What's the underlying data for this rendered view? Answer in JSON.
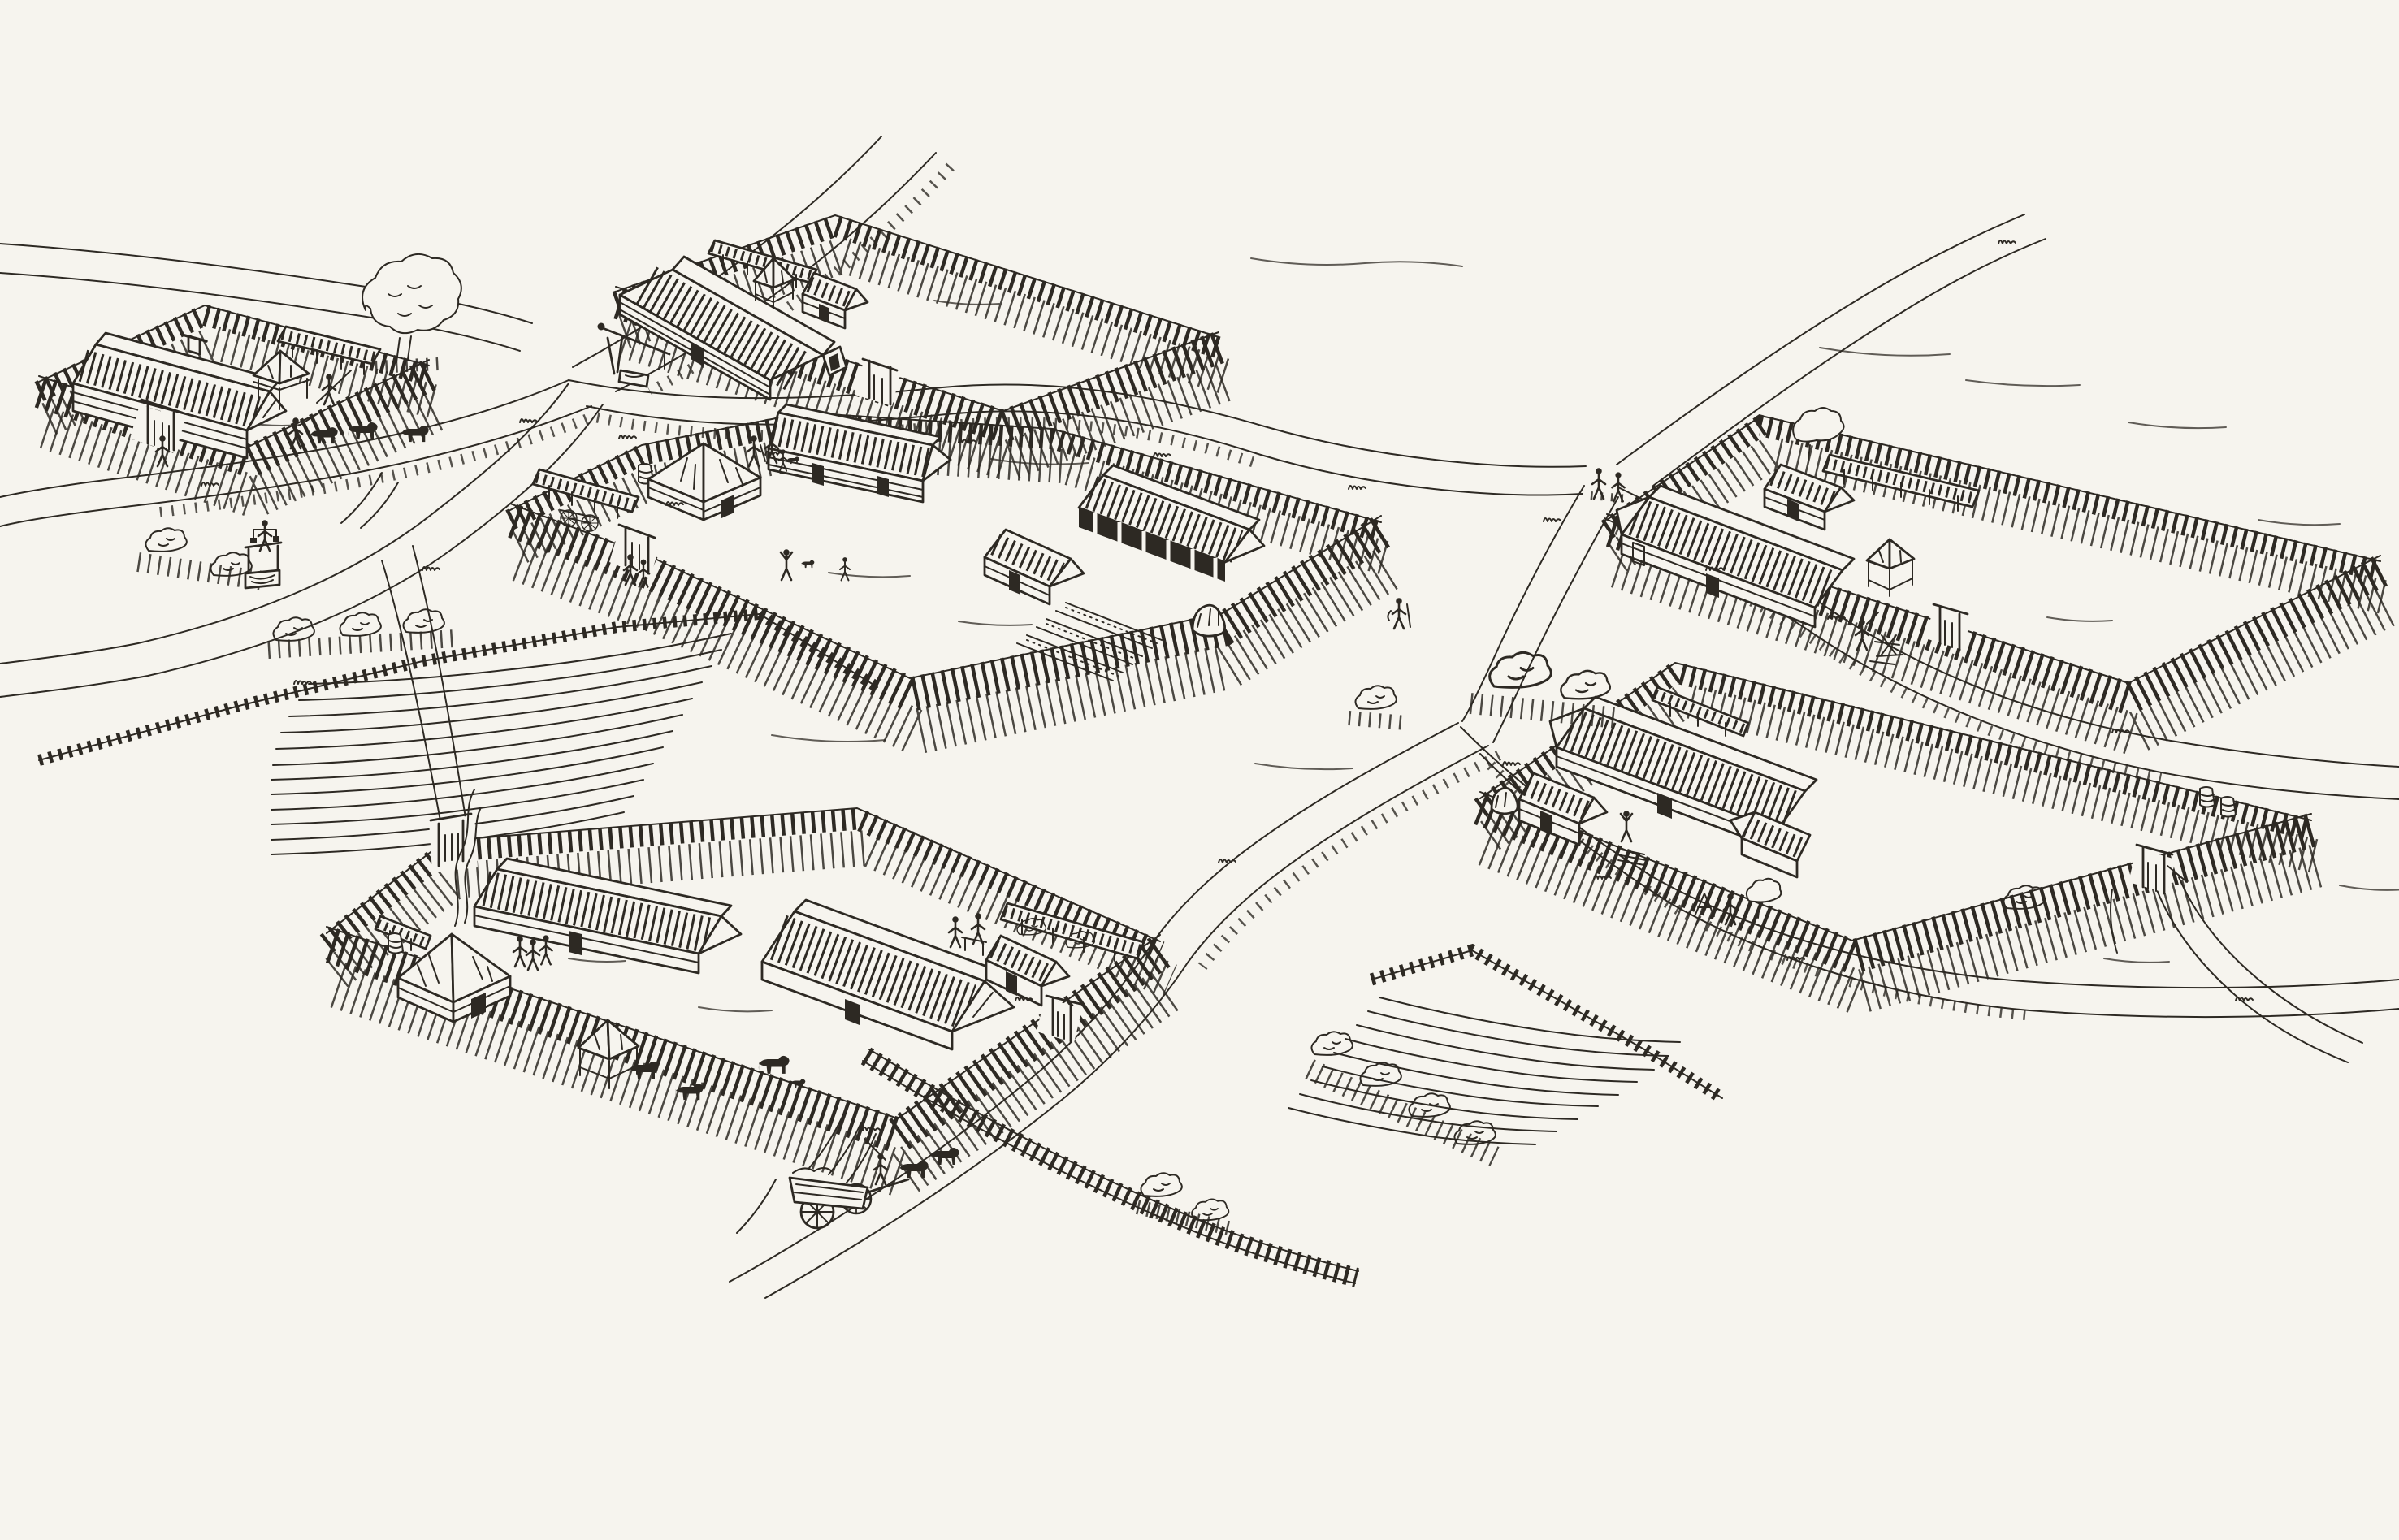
{
  "scene": {
    "title": "Aerial pen-and-ink reconstruction drawing of an early medieval village: six palisaded farmsteads with thatched log buildings along winding rural roads, ploughed strip fields, wells, villagers and livestock",
    "medium": "black ink line illustration on cream paper, high oblique bird's-eye view",
    "colors": {
      "paper": "#f6f4ee",
      "ink": "#2d2923"
    },
    "farmsteads": [
      {
        "id": "north-west-farmstead",
        "features": [
          "oval palisade fence",
          "thatched log longhouse with roof stack",
          "raised granary with pyramidal thatched roof",
          "open lean-to shelter along the fence",
          "large tree at the fence corner",
          "gate with lintel",
          "villager carrying a pole",
          "herdsman driving cattle on the road outside"
        ]
      },
      {
        "id": "north-central-farmstead",
        "features": [
          "large palisade enclosure with empty forecourt",
          "long thatched dwelling house with dark doorway",
          "small thatched outbuilding",
          "raised granary on posts",
          "open shelter along the rear fence",
          "gate",
          "timber well with posts and bucket outside the fence"
        ]
      },
      {
        "id": "central-farmstead",
        "features": [
          "large rounded palisade enclosure",
          "square house with pyramidal thatched roof",
          "long thatched house with two doors",
          "open-fronted thatched byre",
          "small thatched outbuilding",
          "lean-to shed sheltering a two-wheeled cart",
          "storage barrel",
          "vegetable garden plots",
          "haystack",
          "family with dog in the yard",
          "visitors at the gate"
        ]
      },
      {
        "id": "north-east-farmstead",
        "features": [
          "long palisade enclosure",
          "long thatched log house",
          "second thatched house behind",
          "open shelter along the rear fence",
          "raised granary with pyramidal roof",
          "man chopping firewood at a sawbuck",
          "gate",
          "two neighbours talking on the road outside"
        ]
      },
      {
        "id": "east-farmstead",
        "features": [
          "palisade enclosure",
          "large L-shaped thatched house",
          "small thatched house with dark doorway",
          "haystack",
          "open shelter along the rear fence",
          "storage barrels",
          "wood pile and trestle",
          "villager with raised arms",
          "walking villager",
          "young tree",
          "gate opening to a lane"
        ]
      },
      {
        "id": "south-west-farmstead",
        "features": [
          "large palisade enclosure with two gates",
          "square house with pyramidal roof and rising smoke",
          "long thatched log house",
          "great thatched barn",
          "small thatched house",
          "raised granary on posts",
          "lean-to shed with barrel",
          "open shelter along the fence with bushes",
          "three villagers talking",
          "two villagers working at a bench",
          "grazing cows and a dog",
          "ox cart with driver leaving along the lane"
        ]
      }
    ],
    "landscape": {
      "roads": [
        "road to the northern horizon",
        "main east-west village road",
        "crossroads with two villagers talking",
        "lane past the north-west farmstead to the west edge",
        "south-western lane past the draw well",
        "road to the north-east horizon",
        "road east between the farmsteads",
        "lane south-east past the fields",
        "cart lane leaving the village at the south"
      ],
      "fields": [
        "ploughed strip field in the west with bush row and wattle fences",
        "ploughed strip field in the south-east with lattice fence and hedgerow"
      ],
      "wells": [
        "timber draw well with sweep outside the north-central farmstead",
        "timber-framed draw well by the western lane"
      ],
      "figures": [
        "woman carrying buckets on a shoulder yoke",
        "two villagers talking at the crossroads",
        "traveller with staff on the eastern road",
        "herdsman with cattle",
        "carter driving two oxen"
      ],
      "vegetation": [
        "large tree in the north-west farmstead",
        "small tree at the north-east fence",
        "bushes at the crossroads",
        "hedgerow by the south-east field",
        "grass tufts along the road verges"
      ]
    }
  }
}
